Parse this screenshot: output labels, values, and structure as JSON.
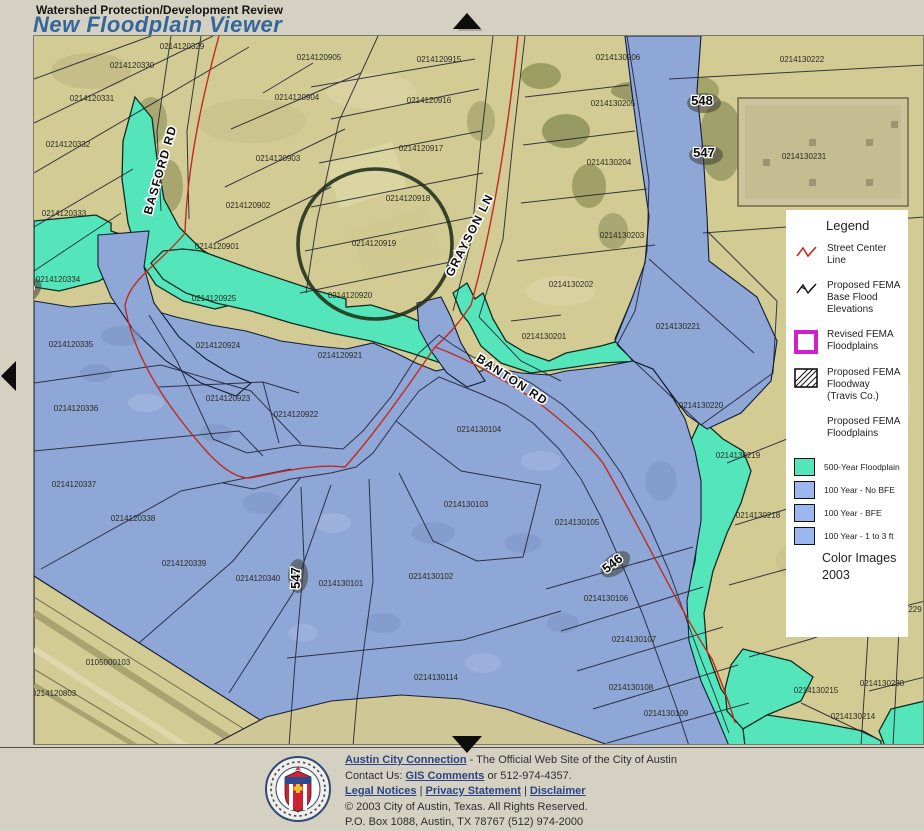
{
  "header": {
    "kicker": "Watershed Protection/Development Review",
    "title": "New Floodplain Viewer"
  },
  "colors": {
    "title_blue": "#33669c",
    "teal_500yr": "#54e6ba",
    "blue_100yr": "#8ea7d6",
    "legend_swatch_blue": "#9cb6ef",
    "revised_magenta": "#cf1fcf",
    "street_centerline_red": "#c22a20",
    "page_background": "#d5d1c2"
  },
  "map": {
    "street_labels": [
      {
        "text": "BASFORD RD",
        "x": 163,
        "y": 170,
        "rot": -74
      },
      {
        "text": "GRAYSON LN",
        "x": 472,
        "y": 236,
        "rot": -63
      },
      {
        "text": "BANTON RD",
        "x": 509,
        "y": 382,
        "rot": 33
      }
    ],
    "shield_labels": [
      {
        "text": "548",
        "x": 701,
        "y": 104,
        "rot": 0
      },
      {
        "text": "547",
        "x": 703,
        "y": 156,
        "rot": 0
      },
      {
        "text": "548",
        "x": 26,
        "y": 294,
        "rot": -42
      },
      {
        "text": "547",
        "x": 299,
        "y": 577,
        "rot": -90
      },
      {
        "text": "546",
        "x": 614,
        "y": 566,
        "rot": -38
      }
    ],
    "parcel_labels": [
      {
        "id": "0214120329",
        "x": 181,
        "y": 48
      },
      {
        "id": "0214120330",
        "x": 131,
        "y": 67
      },
      {
        "id": "0214120905",
        "x": 318,
        "y": 59
      },
      {
        "id": "0214120915",
        "x": 438,
        "y": 61
      },
      {
        "id": "0214130206",
        "x": 617,
        "y": 59
      },
      {
        "id": "0214130222",
        "x": 801,
        "y": 61
      },
      {
        "id": "0214120331",
        "x": 91,
        "y": 100
      },
      {
        "id": "0214120904",
        "x": 296,
        "y": 99
      },
      {
        "id": "0214120916",
        "x": 428,
        "y": 102
      },
      {
        "id": "0214130205",
        "x": 612,
        "y": 105
      },
      {
        "id": "0214120332",
        "x": 67,
        "y": 146
      },
      {
        "id": "0214120903",
        "x": 277,
        "y": 160
      },
      {
        "id": "0214120917",
        "x": 420,
        "y": 150
      },
      {
        "id": "0214130204",
        "x": 608,
        "y": 164
      },
      {
        "id": "0214130231",
        "x": 803,
        "y": 158
      },
      {
        "id": "0214120333",
        "x": 63,
        "y": 215
      },
      {
        "id": "0214120902",
        "x": 247,
        "y": 207
      },
      {
        "id": "0214120918",
        "x": 407,
        "y": 200
      },
      {
        "id": "0214130203",
        "x": 621,
        "y": 237
      },
      {
        "id": "0214120901",
        "x": 216,
        "y": 248
      },
      {
        "id": "0214120919",
        "x": 373,
        "y": 245
      },
      {
        "id": "0214130202",
        "x": 570,
        "y": 286
      },
      {
        "id": "0214120334",
        "x": 57,
        "y": 281
      },
      {
        "id": "0214120925",
        "x": 213,
        "y": 300
      },
      {
        "id": "0214120920",
        "x": 349,
        "y": 297
      },
      {
        "id": "0214130221",
        "x": 677,
        "y": 328
      },
      {
        "id": "0214130201",
        "x": 543,
        "y": 338
      },
      {
        "id": "0214120335",
        "x": 70,
        "y": 346
      },
      {
        "id": "0214120924",
        "x": 217,
        "y": 347
      },
      {
        "id": "0214120921",
        "x": 339,
        "y": 357
      },
      {
        "id": "0214130220",
        "x": 700,
        "y": 407
      },
      {
        "id": "0214120923",
        "x": 227,
        "y": 400
      },
      {
        "id": "0214120922",
        "x": 295,
        "y": 416
      },
      {
        "id": "0214130104",
        "x": 478,
        "y": 431
      },
      {
        "id": "0214120336",
        "x": 75,
        "y": 410
      },
      {
        "id": "0214130219",
        "x": 737,
        "y": 457
      },
      {
        "id": "0214120337",
        "x": 73,
        "y": 486
      },
      {
        "id": "0214130103",
        "x": 465,
        "y": 506
      },
      {
        "id": "0214130218",
        "x": 757,
        "y": 517
      },
      {
        "id": "0214120338",
        "x": 132,
        "y": 520
      },
      {
        "id": "0214130105",
        "x": 576,
        "y": 524
      },
      {
        "id": "0214120339",
        "x": 183,
        "y": 565
      },
      {
        "id": "0214120340",
        "x": 257,
        "y": 580
      },
      {
        "id": "0214130101",
        "x": 340,
        "y": 585
      },
      {
        "id": "0214130102",
        "x": 430,
        "y": 578
      },
      {
        "id": "0214130106",
        "x": 605,
        "y": 600
      },
      {
        "id": "229",
        "x": 914,
        "y": 611
      },
      {
        "id": "0214130107",
        "x": 633,
        "y": 641
      },
      {
        "id": "0105000103",
        "x": 107,
        "y": 664
      },
      {
        "id": "0214130114",
        "x": 435,
        "y": 679
      },
      {
        "id": "0214130108",
        "x": 630,
        "y": 689
      },
      {
        "id": "0214130230",
        "x": 881,
        "y": 685
      },
      {
        "id": "0214120803",
        "x": 53,
        "y": 695
      },
      {
        "id": "0214130215",
        "x": 815,
        "y": 692
      },
      {
        "id": "0214130109",
        "x": 665,
        "y": 715
      },
      {
        "id": "0214130214",
        "x": 852,
        "y": 718
      }
    ]
  },
  "legend": {
    "title": "Legend",
    "items": [
      {
        "icon": "red-zigzag-icon",
        "lines": [
          "Street Center",
          "Line"
        ]
      },
      {
        "icon": "black-zigzag-icon",
        "lines": [
          "Proposed FEMA",
          "Base Flood",
          "Elevations"
        ]
      },
      {
        "icon": "magenta-box-icon",
        "lines": [
          "Revised FEMA",
          "Floodplains"
        ]
      },
      {
        "icon": "hatch-box-icon",
        "lines": [
          "Proposed FEMA",
          "Floodway",
          "(Travis Co.)"
        ]
      },
      {
        "icon": "none",
        "lines": [
          "Proposed FEMA",
          "Floodplains"
        ]
      }
    ],
    "swatches": [
      {
        "color": "#54e6ba",
        "label": "500-Year Floodplain"
      },
      {
        "color": "#9cb6ef",
        "label": "100 Year - No BFE"
      },
      {
        "color": "#9cb6ef",
        "label": "100 Year - BFE"
      },
      {
        "color": "#9cb6ef",
        "label": "100 Year - 1 to 3 ft"
      }
    ],
    "note_lines": [
      "Color Images",
      "2003"
    ]
  },
  "footer": {
    "site_link": "Austin City Connection",
    "site_rest": " - The Official Web Site of the City of Austin",
    "contact_prefix": "Contact Us: ",
    "contact_link": "GIS Comments",
    "contact_rest": " or 512-974-4357.",
    "legal_links": [
      "Legal Notices",
      "Privacy Statement",
      "Disclaimer"
    ],
    "legal_separator": " | ",
    "copyright": "© 2003 City of Austin, Texas. All Rights Reserved.",
    "address": "P.O. Box 1088, Austin, TX 78767 (512) 974-2000"
  }
}
